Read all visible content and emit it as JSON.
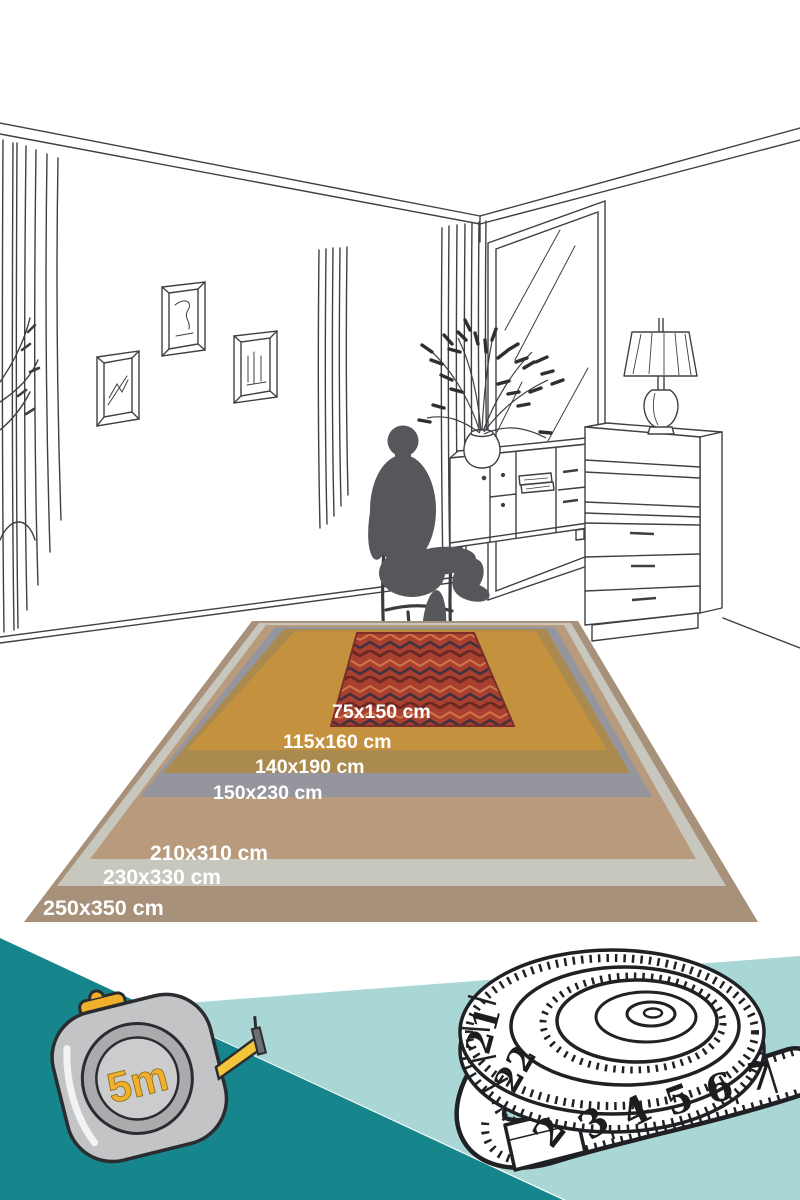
{
  "illustration": {
    "type": "rug-size-guide",
    "room_elements": [
      "curtains",
      "picture-frames",
      "window",
      "sideboard",
      "shelf-unit",
      "table-lamp",
      "plant-vase",
      "person-on-chair"
    ]
  },
  "rug_sizes": [
    {
      "label": "250x350 cm",
      "color": "#a8917a"
    },
    {
      "label": "230x330 cm",
      "color": "#c7c7be"
    },
    {
      "label": "210x310 cm",
      "color": "#b79b7c"
    },
    {
      "label": "150x230 cm",
      "color": "#95959e"
    },
    {
      "label": "140x190 cm",
      "color": "#aa8a4e"
    },
    {
      "label": "115x160 cm",
      "color": "#c4923f"
    },
    {
      "label": "75x150 cm",
      "color": "#a8402f"
    }
  ],
  "tape_measure": {
    "label": "5m",
    "accent_color": "#f0b02c"
  },
  "tailor_tape": {
    "numbers": [
      "21",
      "22",
      "2",
      "3",
      "4",
      "5",
      "6",
      "7"
    ]
  },
  "palette": {
    "dark_teal": "#17858c",
    "light_teal": "#a9d7d6",
    "silhouette_gray": "#56575a",
    "line_art": "#3f4044",
    "rug_red_pattern_dark": "#6b2823",
    "rug_red_pattern_light": "#d2754a"
  }
}
